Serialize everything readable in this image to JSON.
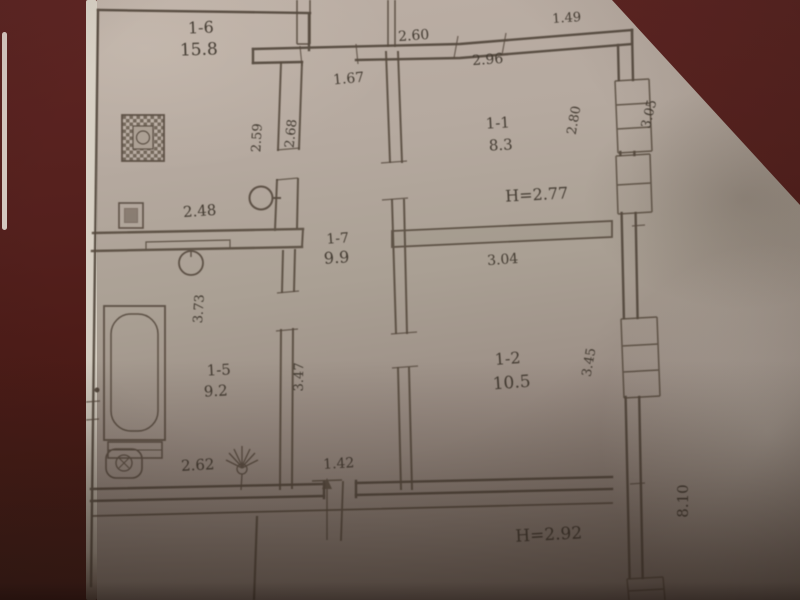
{
  "photo": {
    "background_color": "#4e1c19",
    "paper_color": "#b3a79d",
    "line_color": "#55493d",
    "text_color": "#3e362d",
    "description": "Scanned photo of an apartment floor plan on grey paper with dark red backing visible at edges"
  },
  "plan": {
    "rooms": {
      "r16": {
        "id": "1-6",
        "area": "15.8"
      },
      "r11": {
        "id": "1-1",
        "area": "8.3",
        "ceiling_height": "H=2.77"
      },
      "r17": {
        "id": "1-7",
        "area": "9.9"
      },
      "r12": {
        "id": "1-2",
        "area": "10.5"
      },
      "r15": {
        "id": "1-5",
        "area": "9.2"
      },
      "lower": {
        "ceiling_height": "H=2.92"
      }
    },
    "dimensions": {
      "top_left": "2.60",
      "top_right": "1.49",
      "room11_top": "2.96",
      "hall_top": "1.67",
      "kitchen_east_a": "2.59",
      "kitchen_east_b": "2.68",
      "room11_east": "2.80",
      "east_upper": "3.05",
      "kitchen_south": "2.48",
      "room12_top": "3.04",
      "bath_west": "3.73",
      "bath_east": "3.47",
      "room12_east": "3.45",
      "bath_south": "2.62",
      "hall_south": "1.42",
      "east_total": "8.10"
    },
    "fixtures": [
      "stove",
      "kitchen-sink",
      "boiler",
      "bathtub",
      "toilet",
      "shower",
      "chimney",
      "vent-stack"
    ]
  }
}
